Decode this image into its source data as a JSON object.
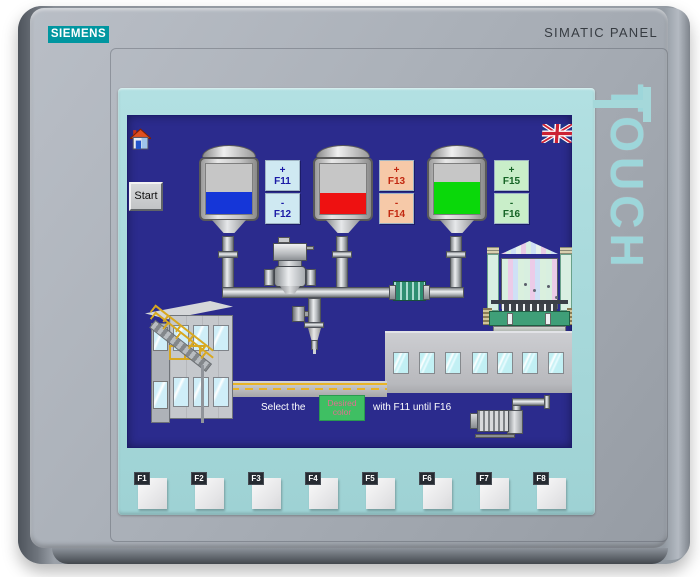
{
  "device": {
    "brand": "SIEMENS",
    "product_label": "SIMATIC PANEL",
    "touch_label": "TOUCH",
    "colors": {
      "logo_teal": "#0096a0",
      "bezel_teal": "#a5d8da",
      "frame_gray": "#9aa0a8"
    }
  },
  "screen": {
    "background_color": "#2b2b8d",
    "start_button": {
      "label": "Start"
    },
    "tanks": [
      {
        "name": "blue-tank",
        "liquid_color": "#1536d8",
        "fill": "45%"
      },
      {
        "name": "red-tank",
        "liquid_color": "#ee1111",
        "fill": "42%"
      },
      {
        "name": "green-tank",
        "liquid_color": "#0ad80a",
        "fill": "65%"
      }
    ],
    "tank_controls": [
      {
        "inc": "+",
        "inc_key": "F11",
        "dec": "-",
        "dec_key": "F12",
        "bg": "#cfe9f2",
        "fg": "#1a1aa6"
      },
      {
        "inc": "+",
        "inc_key": "F13",
        "dec": "-",
        "dec_key": "F14",
        "bg": "#f6c9a8",
        "fg": "#c22810"
      },
      {
        "inc": "+",
        "inc_key": "F15",
        "dec": "-",
        "dec_key": "F16",
        "bg": "#c9eec9",
        "fg": "#156325"
      }
    ],
    "instruction": {
      "prefix": "Select the",
      "highlight_word_line1": "Desired",
      "highlight_word_line2": "color",
      "highlight_bg": "#3fbf63",
      "highlight_fg": "#e07090",
      "suffix": "with F11 until F16"
    }
  },
  "function_keys": [
    {
      "label": "F1"
    },
    {
      "label": "F2"
    },
    {
      "label": "F3"
    },
    {
      "label": "F4"
    },
    {
      "label": "F5"
    },
    {
      "label": "F6"
    },
    {
      "label": "F7"
    },
    {
      "label": "F8"
    }
  ]
}
